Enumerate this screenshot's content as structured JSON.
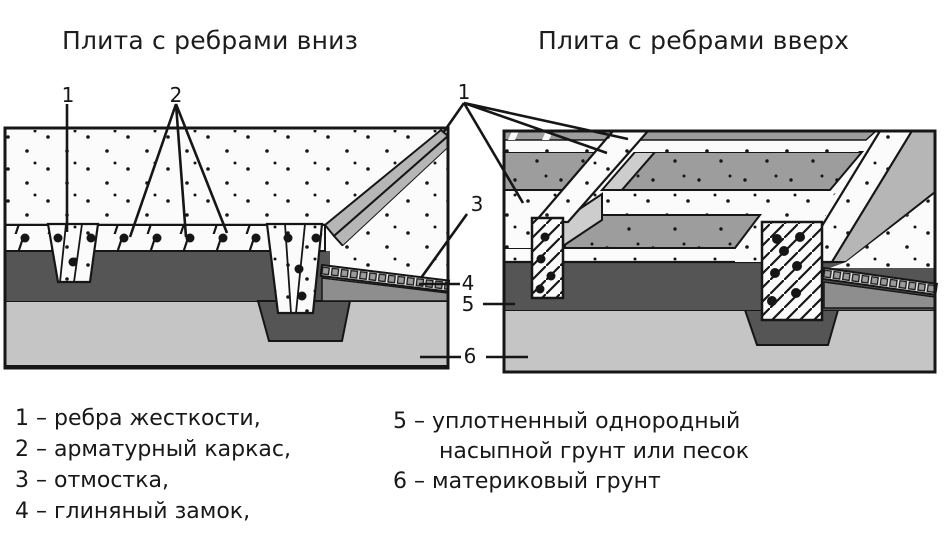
{
  "titles": {
    "left": "Плита с ребрами вниз",
    "right": "Плита с ребрами вверх"
  },
  "callouts": {
    "ribs_down_1": "1",
    "ribs_down_2": "2",
    "ribs_up_1": "1",
    "blind_area_3": "3",
    "clay_lock_4": "4",
    "fill_soil_5": "5",
    "native_soil_6": "6"
  },
  "legend": {
    "left": [
      "1 – ребра жесткости,",
      "2 – арматурный каркас,",
      "3 – отмостка,",
      "4 – глиняный замок,"
    ],
    "right": [
      "5 – уплотненный однородный",
      "насыпной грунт или песок",
      "6 – материковый грунт"
    ]
  },
  "palette": {
    "ink": "#161616",
    "white_concrete": "#fbfbfb",
    "dark_fill_soil": "#555555",
    "native_soil": "#c5c5c5",
    "panel_gray": "#9d9d9d",
    "blind_area_gray": "#b6b6b6",
    "bevel_gray": "#cdcdcd",
    "clay_strip_gray": "#8e8e8e"
  }
}
